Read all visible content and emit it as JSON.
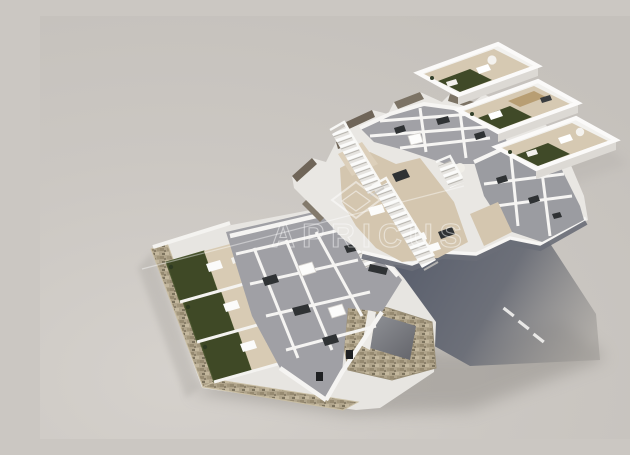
{
  "scene": {
    "title": "3D isometric cutaway floor-plan render of a residential complex",
    "watermark": {
      "text": "APRICUS",
      "logo": "diamond-outline-logo"
    },
    "sections": [
      "solarium level: three stepped roof terraces with artificial turf, beige decks, white parapets and outdoor furniture",
      "first floor: cutaway apartments with grey floors, central beige roof deck, exterior white staircases",
      "ground floor: apartments with private green gardens, beige patios and stone perimeter wall",
      "garage ramp enclosed in stone cladding",
      "dark asphalt street with white lane dashes fading into cast shadow",
      "neutral grey studio backdrop"
    ],
    "palette": {
      "backdrop": "#cbc7c2",
      "backdrop_light": "#d3cfca",
      "cast_shadow": "#9d9994",
      "street_dark": "#59606f",
      "wall_white": "#f2f1ee",
      "wall_shade": "#dcd9d4",
      "floor_gray": "#a0a0a5",
      "deck_beige": "#d5c7b0",
      "turf_green": "#3f4926",
      "cut_wall_taupe": "#6f6558",
      "stone_tan": "#b0a48b",
      "furniture_dark": "#2f3234",
      "pergola_wood": "#b59a6e"
    }
  }
}
